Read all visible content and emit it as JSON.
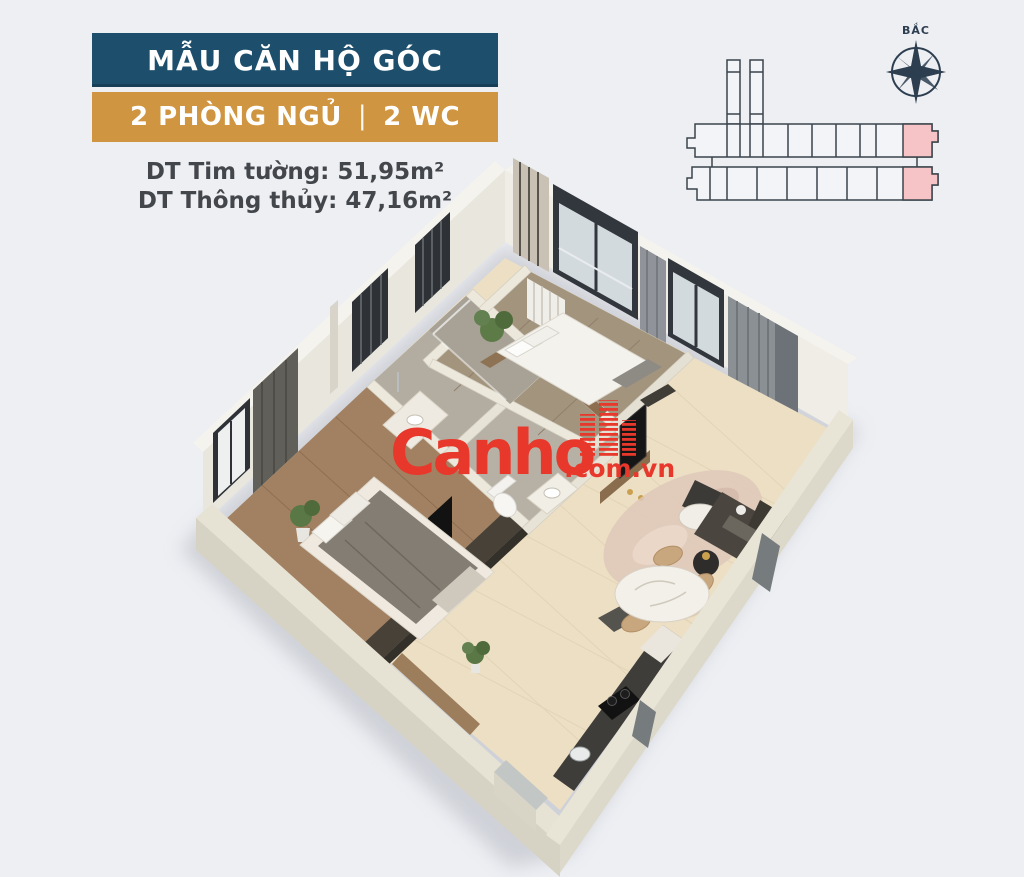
{
  "header": {
    "title": "MẪU CĂN HỘ GÓC",
    "bedrooms": "2 PHÒNG NGỦ",
    "separator": "|",
    "wc": "2 WC",
    "area1_label": "DT Tim tường:",
    "area1_value": "51,95m²",
    "area2_label": "DT Thông thủy:",
    "area2_value": "47,16m²",
    "title_bg_color": "#1d4f6c",
    "subtitle_bg_color": "#d09540"
  },
  "keyplan": {
    "compass_label": "BẮC",
    "line_color": "#3a434c",
    "highlight_color": "#f6c4c6",
    "highlighted_units_count": 2,
    "rows": 2,
    "towers": 2
  },
  "watermark": {
    "brand": "Canho",
    "domain": ".com.vn",
    "color": "#e8372b",
    "icon": "building-stripes-icon"
  },
  "floorplan": {
    "style": "3d-isometric-apartment-render",
    "rooms": [
      "master-bedroom",
      "bedroom-2",
      "bathroom-1",
      "bathroom-2",
      "entry-hall",
      "living-dining",
      "kitchen"
    ],
    "colors": {
      "wall_face": "#e9e6dd",
      "wall_top": "#f5f3ed",
      "floor_tile": "#ecdfc4",
      "floor_wood": "#a28162",
      "bath_floor": "#b3ada1",
      "window_frame": "#2e3237",
      "curtain": "#8b9095",
      "background": "#edeff3"
    }
  }
}
